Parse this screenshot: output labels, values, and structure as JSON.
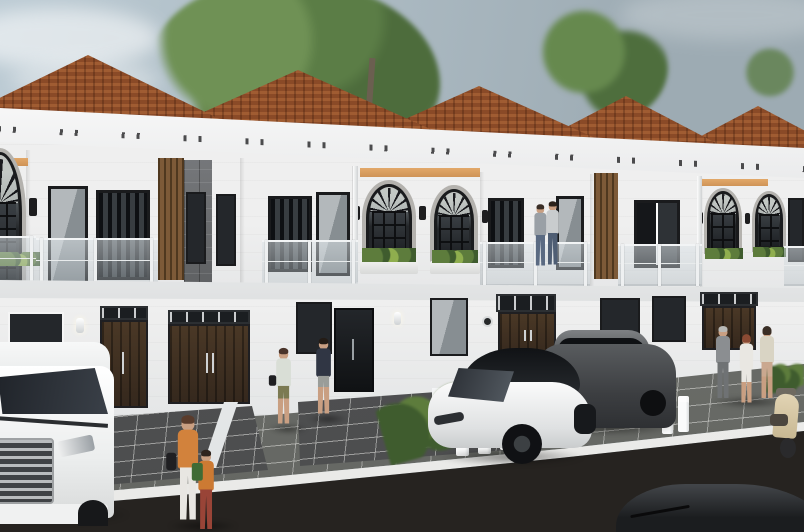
{
  "scene": {
    "type": "3d-architectural-exterior-render",
    "subject": "Row of modern two-story townhouses with terracotta hip roofs, white facades, arched upstairs windows, glass balconies, paved driveways and a street in front",
    "time_of_day": "daytime",
    "houses": {
      "visible_units": 6,
      "stories": 2,
      "features": [
        "terracotta tiled hip roofs",
        "white cornice with dark dentil accents",
        "black-framed arched windows with fan muntins",
        "glass balcony railings with white posts",
        "vertical wood-slat accent panels",
        "gray stone-tile accent panel",
        "peach accent strips under the eaves",
        "dark brown double entry doors",
        "wall sconce lamps",
        "planter boxes with grasses under arched windows"
      ]
    },
    "vehicles": [
      {
        "name": "white-mpv-van",
        "position": "far left driveway"
      },
      {
        "name": "white-sedan",
        "position": "center driveway"
      },
      {
        "name": "dark-gray-suv",
        "position": "right of white sedan"
      },
      {
        "name": "beige-scooter",
        "position": "far right curb"
      },
      {
        "name": "dark-car-roof",
        "position": "bottom right foreground"
      }
    ],
    "people": [
      {
        "name": "woman-walking",
        "desc": "light top, olive shorts, black tote",
        "position": "center walkway"
      },
      {
        "name": "man-walking",
        "desc": "dark tee and shorts",
        "position": "center walkway"
      },
      {
        "name": "woman-with-bag",
        "desc": "orange top, white pants",
        "position": "left sidewalk"
      },
      {
        "name": "child-with-backpack",
        "desc": "orange jacket, green backpack, red pants",
        "position": "left sidewalk"
      },
      {
        "name": "couple-on-balcony",
        "desc": "two people at glass railing",
        "position": "upper balcony right of center"
      },
      {
        "name": "man-in-suit",
        "desc": "gray suit",
        "position": "right sidewalk group"
      },
      {
        "name": "woman-in-white",
        "desc": "auburn hair",
        "position": "right sidewalk group"
      },
      {
        "name": "woman-in-beige",
        "desc": "tan skirt",
        "position": "right sidewalk group"
      }
    ],
    "vegetation": [
      "large green trees behind the roofline",
      "hedge row along center driveway",
      "shrubs at right sidewalk",
      "grass tufts in balcony planters"
    ],
    "street": {
      "elements": [
        "dark paver driveways",
        "gray paver sidewalk",
        "white curb",
        "dark asphalt road",
        "low white fence pillars",
        "white boundary walls"
      ]
    }
  },
  "palette": {
    "sky1": "#bccbd4",
    "sky2": "#9dabb3",
    "roof": "#8a4a27",
    "roofLight": "#a05c32",
    "wall": "#efefef",
    "wallShade": "#d9dbdc",
    "frame": "#1a1b1d",
    "surround": "#b4b2ae",
    "wood": "#7d5a38",
    "woodDark": "#4f381f",
    "accent": "#e2a869",
    "railPost": "#eef0f1",
    "doorWood": "#35281d",
    "doorWood2": "#4a3826",
    "plant": "#5d7c3c",
    "plantDark": "#3f5c2e",
    "paverDark": "#4c4d4e",
    "paverLight": "#72746f",
    "curb": "#e9e9e7",
    "road": "#383430",
    "skin": "#c99f82"
  }
}
